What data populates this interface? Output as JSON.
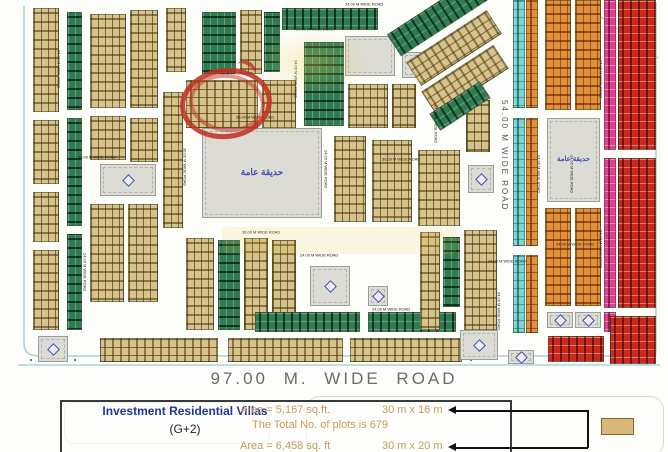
{
  "map": {
    "road_labels": {
      "r24": "24.00 M WIDE ROAD",
      "r36": "36.00 M WIDE ROAD",
      "r54": "54.00  M  WIDE  ROAD",
      "r97": "97.00 M. WIDE ROAD"
    },
    "park_label": "حديقة عامة",
    "colors": {
      "tan": "#d5c28c",
      "green": "#2e7d52",
      "cyan": "#7bd8cc",
      "orange": "#e0913c",
      "red": "#cc2a1c",
      "magenta": "#e23d8e",
      "gray": "#dcdcd4",
      "road_edge": "#a7d6da",
      "annotation": "#c23b28"
    },
    "blocks": [
      [
        33,
        8,
        26,
        104,
        "tan",
        "v"
      ],
      [
        33,
        120,
        26,
        64,
        "tan",
        "v"
      ],
      [
        33,
        192,
        26,
        50,
        "tan",
        "v"
      ],
      [
        33,
        250,
        26,
        80,
        "tan",
        "v"
      ],
      [
        67,
        12,
        15,
        98,
        "green",
        "v"
      ],
      [
        67,
        118,
        15,
        108,
        "green",
        "v"
      ],
      [
        67,
        234,
        15,
        96,
        "green",
        "v"
      ],
      [
        90,
        14,
        36,
        94,
        "tan",
        "v"
      ],
      [
        130,
        10,
        28,
        98,
        "tan",
        "v"
      ],
      [
        90,
        116,
        36,
        44,
        "tan",
        "v"
      ],
      [
        130,
        118,
        28,
        44,
        "tan",
        "v"
      ],
      [
        100,
        164,
        56,
        32,
        "gray",
        "icon"
      ],
      [
        90,
        204,
        34,
        98,
        "tan",
        "v"
      ],
      [
        128,
        204,
        30,
        98,
        "tan",
        "v"
      ],
      [
        38,
        336,
        30,
        26,
        "gray",
        "icon"
      ],
      [
        163,
        92,
        20,
        136,
        "tan",
        "v"
      ],
      [
        166,
        8,
        20,
        64,
        "tan",
        "v"
      ],
      [
        202,
        12,
        34,
        62,
        "green",
        "v"
      ],
      [
        240,
        10,
        22,
        64,
        "tan",
        "v"
      ],
      [
        264,
        12,
        16,
        60,
        "green",
        "v"
      ],
      [
        186,
        80,
        72,
        48,
        "tan",
        "h"
      ],
      [
        262,
        80,
        34,
        48,
        "tan",
        "v"
      ],
      [
        202,
        128,
        120,
        90,
        "gray",
        "park"
      ],
      [
        186,
        238,
        28,
        92,
        "tan",
        "v"
      ],
      [
        218,
        240,
        22,
        90,
        "green",
        "v"
      ],
      [
        244,
        238,
        24,
        92,
        "tan",
        "v"
      ],
      [
        272,
        240,
        24,
        88,
        "tan",
        "v"
      ],
      [
        310,
        266,
        40,
        40,
        "gray",
        "icon"
      ],
      [
        368,
        286,
        20,
        20,
        "gray",
        "icon"
      ],
      [
        255,
        312,
        105,
        20,
        "green",
        "h"
      ],
      [
        368,
        312,
        88,
        20,
        "green",
        "h"
      ],
      [
        100,
        338,
        118,
        24,
        "tan",
        "h"
      ],
      [
        228,
        338,
        115,
        24,
        "tan",
        "h"
      ],
      [
        350,
        338,
        112,
        24,
        "tan",
        "h"
      ],
      [
        460,
        330,
        38,
        30,
        "gray",
        "icon"
      ],
      [
        282,
        8,
        96,
        22,
        "green",
        "h"
      ],
      [
        304,
        42,
        40,
        84,
        "green",
        "v"
      ],
      [
        345,
        36,
        50,
        40,
        "gray",
        "plain"
      ],
      [
        402,
        52,
        28,
        26,
        "gray",
        "icon"
      ],
      [
        348,
        84,
        40,
        44,
        "tan",
        "v"
      ],
      [
        392,
        84,
        24,
        44,
        "tan",
        "v"
      ],
      [
        334,
        136,
        32,
        86,
        "tan",
        "v"
      ],
      [
        372,
        140,
        40,
        82,
        "tan",
        "v"
      ],
      [
        418,
        150,
        42,
        76,
        "tan",
        "v"
      ],
      [
        466,
        100,
        24,
        52,
        "tan",
        "v"
      ],
      [
        468,
        165,
        26,
        28,
        "gray",
        "icon"
      ],
      [
        385,
        2,
        112,
        26,
        "green",
        "h",
        -33
      ],
      [
        406,
        34,
        96,
        28,
        "tan",
        "h",
        -33
      ],
      [
        422,
        66,
        86,
        28,
        "tan",
        "h",
        -33
      ],
      [
        430,
        96,
        60,
        20,
        "green",
        "h",
        -33
      ],
      [
        420,
        232,
        20,
        98,
        "tan",
        "v"
      ],
      [
        443,
        237,
        17,
        70,
        "green",
        "v"
      ],
      [
        464,
        230,
        33,
        100,
        "tan",
        "v"
      ],
      [
        513,
        0,
        12,
        108,
        "cyan",
        "h"
      ],
      [
        526,
        0,
        12,
        108,
        "orange",
        "h"
      ],
      [
        513,
        118,
        12,
        128,
        "cyan",
        "h"
      ],
      [
        526,
        118,
        12,
        128,
        "orange",
        "h"
      ],
      [
        513,
        255,
        12,
        78,
        "cyan",
        "h"
      ],
      [
        526,
        255,
        12,
        78,
        "orange",
        "h"
      ],
      [
        508,
        350,
        26,
        14,
        "gray",
        "icon"
      ],
      [
        545,
        0,
        26,
        110,
        "orange",
        "v"
      ],
      [
        575,
        0,
        26,
        110,
        "orange",
        "v"
      ],
      [
        547,
        118,
        53,
        84,
        "gray",
        "park"
      ],
      [
        545,
        208,
        26,
        98,
        "orange",
        "v"
      ],
      [
        575,
        208,
        26,
        98,
        "orange",
        "v"
      ],
      [
        547,
        312,
        26,
        16,
        "gray",
        "icon"
      ],
      [
        575,
        312,
        26,
        16,
        "gray",
        "icon"
      ],
      [
        604,
        0,
        12,
        150,
        "magenta",
        "h"
      ],
      [
        604,
        158,
        12,
        150,
        "magenta",
        "h"
      ],
      [
        604,
        312,
        12,
        20,
        "magenta",
        "h"
      ],
      [
        618,
        0,
        38,
        150,
        "red",
        "h"
      ],
      [
        618,
        158,
        38,
        150,
        "red",
        "h"
      ],
      [
        548,
        336,
        56,
        26,
        "red",
        "h"
      ],
      [
        610,
        316,
        46,
        48,
        "red",
        "h"
      ]
    ],
    "labels": [
      [
        "r24",
        345,
        3,
        0
      ],
      [
        "r24",
        296,
        28,
        0
      ],
      [
        "r24",
        215,
        72,
        0
      ],
      [
        "r36",
        236,
        116,
        0
      ],
      [
        "r36",
        78,
        156,
        0
      ],
      [
        "r36",
        242,
        231,
        0
      ],
      [
        "r36",
        382,
        158,
        0
      ],
      [
        "r24",
        300,
        254,
        0
      ],
      [
        "r24",
        372,
        308,
        0
      ],
      [
        "r24",
        488,
        260,
        0
      ],
      [
        "r24",
        556,
        243,
        0
      ],
      [
        "r36",
        186,
        148,
        1
      ],
      [
        "r24",
        60,
        50,
        1
      ],
      [
        "r24",
        86,
        253,
        1
      ],
      [
        "r24",
        327,
        150,
        1
      ],
      [
        "r24",
        297,
        60,
        1
      ],
      [
        "r24",
        437,
        105,
        1
      ],
      [
        "r24",
        540,
        155,
        1
      ],
      [
        "r24",
        573,
        155,
        1
      ],
      [
        "r24",
        602,
        60,
        1
      ],
      [
        "r24",
        602,
        230,
        1
      ],
      [
        "r24",
        500,
        292,
        1
      ],
      [
        "r54",
        508,
        100,
        1,
        1
      ]
    ]
  },
  "legend": {
    "title": "Investment Residential Villas",
    "subtitle": "(G+2)",
    "rows": [
      {
        "area": "Area = 5,167 sq.ft.",
        "dims": "30 m x 16 m"
      },
      {
        "area": "Area = 6,458 sq. ft",
        "dims": "30 m x 20 m"
      }
    ],
    "total": "The Total No. of plots is 679",
    "swatch_color": "#d9b87a"
  }
}
